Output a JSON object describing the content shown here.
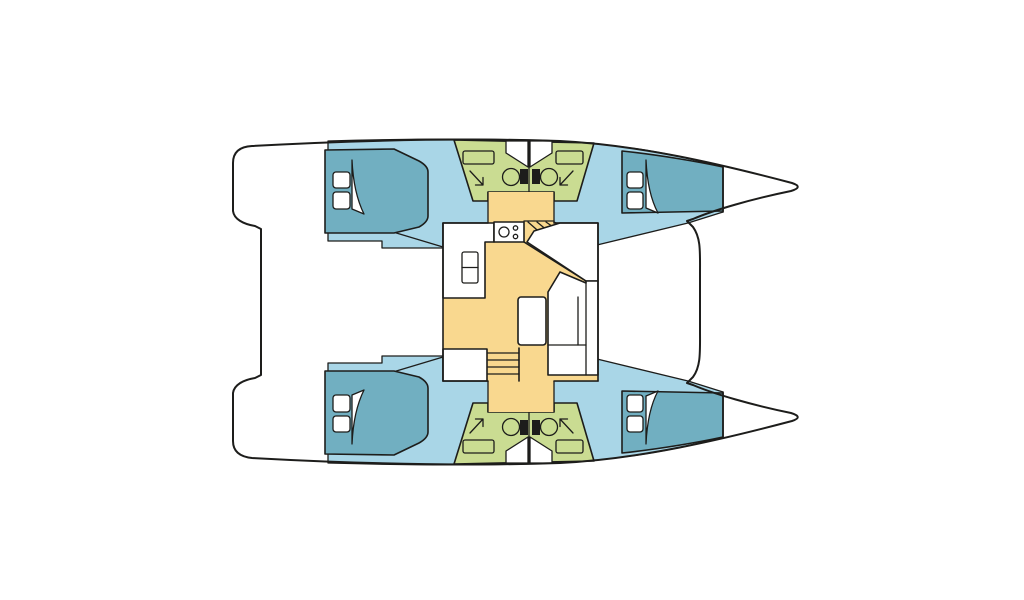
{
  "diagram": {
    "type": "boat-floor-plan",
    "description": "Top-down interior layout plan of a sailing catamaran with two hulls, four double cabins, two split bathroom areas with toilets showers and sinks, and a central bridgedeck salon with galley, stove, stairs and dinette table"
  },
  "colors": {
    "background": "#ffffff",
    "outline": "#1d1d1b",
    "hull_fill": "#ffffff",
    "cabin_floor": "#a9d6e7",
    "bed": "#71afc1",
    "bathroom": "#cadc92",
    "salon_floor": "#f9d88f",
    "furniture": "#ffffff",
    "toilet_tank": "#1d1d1b"
  },
  "legend": {
    "bed": "dark teal berth with two white pillows and curved door blade",
    "toilet": "circle with dark cistern block",
    "sink": "rounded rectangle in bathroom",
    "shower": "diagonal arrow icon",
    "stove": "one large and two small burner circles",
    "stairs": "fanned / parallel tread lines",
    "dinette": "white U-bench with rectangular table"
  },
  "counts": {
    "cabins": 4,
    "bathrooms": 4,
    "hulls": 2
  }
}
